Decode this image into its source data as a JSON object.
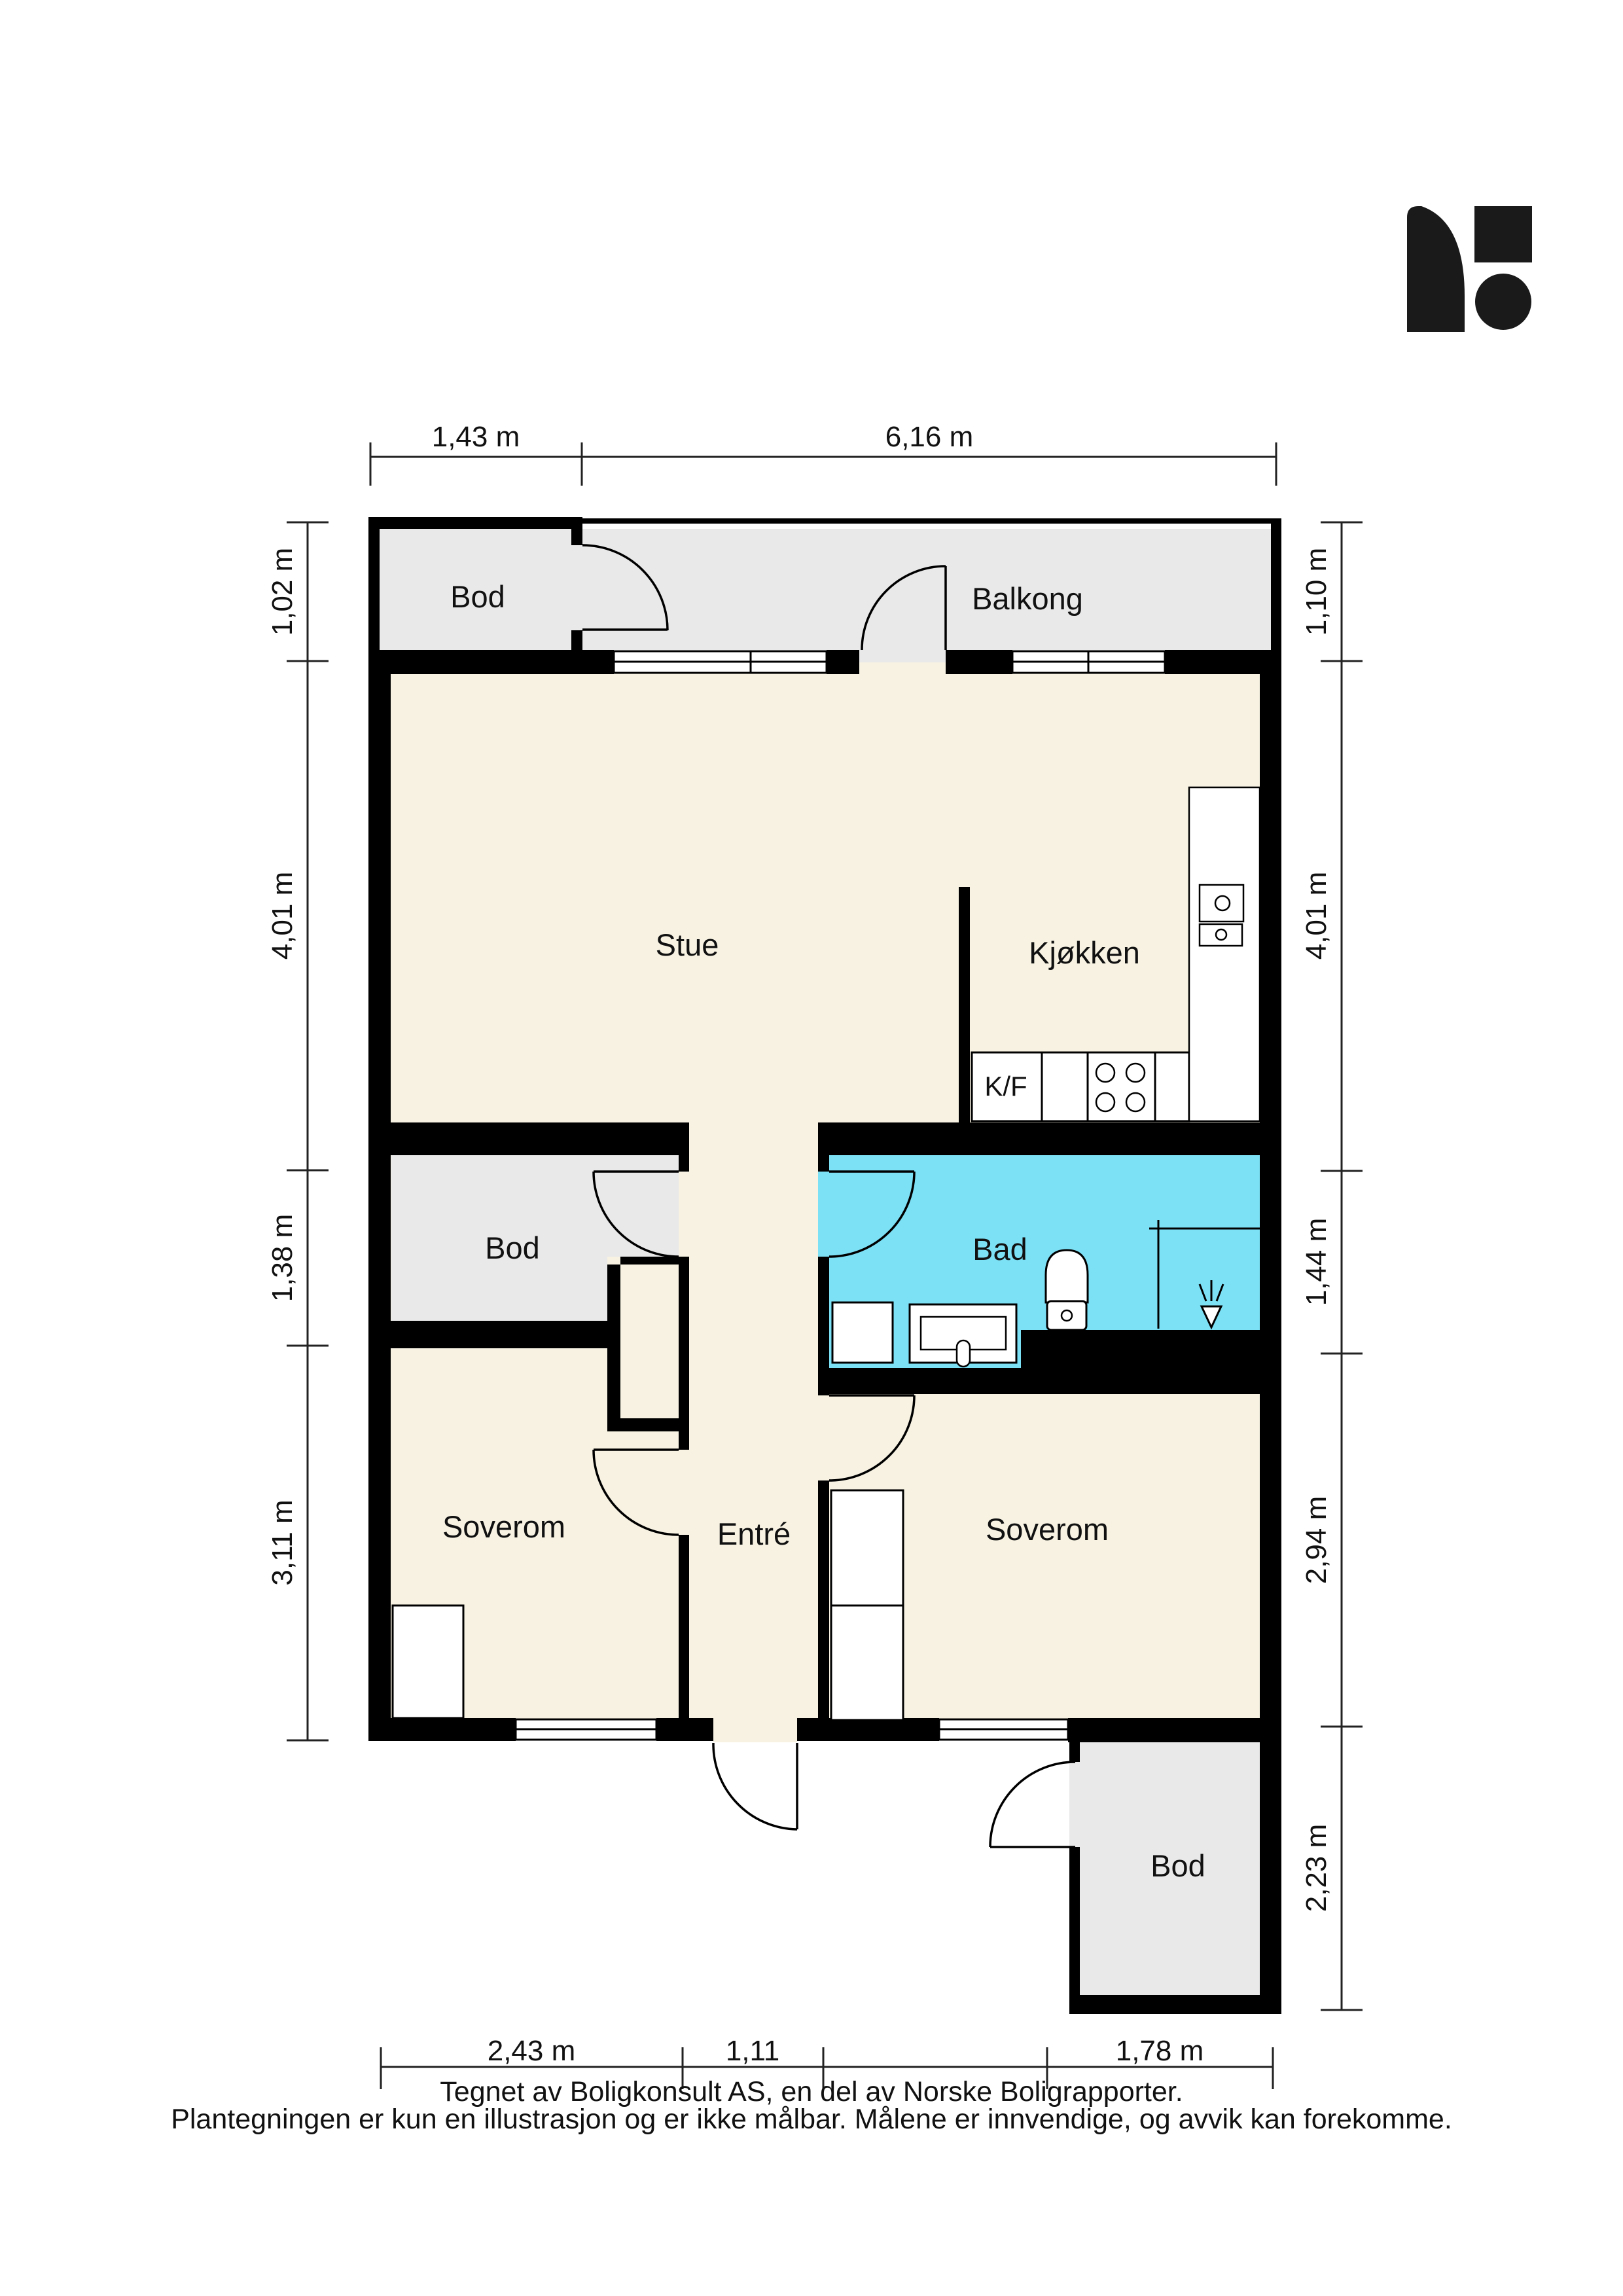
{
  "palette": {
    "floor_main": "#f7f2e2",
    "floor_storage": "#e9e9e9",
    "floor_bath": "#7de1f6",
    "wall": "#000000",
    "logo": "#1a1a1a"
  },
  "rooms": {
    "bod_top": {
      "label": "Bod"
    },
    "balkong": {
      "label": "Balkong"
    },
    "stue": {
      "label": "Stue"
    },
    "kjokken": {
      "label": "Kjøkken"
    },
    "kf": {
      "label": "K/F"
    },
    "bod_mid": {
      "label": "Bod"
    },
    "bad": {
      "label": "Bad"
    },
    "soverom_left": {
      "label": "Soverom"
    },
    "entre": {
      "label": "Entré"
    },
    "soverom_right": {
      "label": "Soverom"
    },
    "bod_bottom": {
      "label": "Bod"
    }
  },
  "dimensions": {
    "top": [
      "1,43 m",
      "6,16 m"
    ],
    "left": [
      "1,02 m",
      "4,01 m",
      "1,38 m",
      "3,11 m"
    ],
    "right": [
      "1,10 m",
      "4,01 m",
      "1,44 m",
      "2,94 m",
      "2,23 m"
    ],
    "bottom": [
      "2,43 m",
      "1,11",
      "1,78 m"
    ]
  },
  "footer": {
    "line1": "Tegnet av Boligkonsult AS, en del av Norske Boligrapporter.",
    "line2": "Plantegningen er kun en illustrasjon og er ikke målbar. Målene er innvendige, og avvik kan forekomme."
  }
}
